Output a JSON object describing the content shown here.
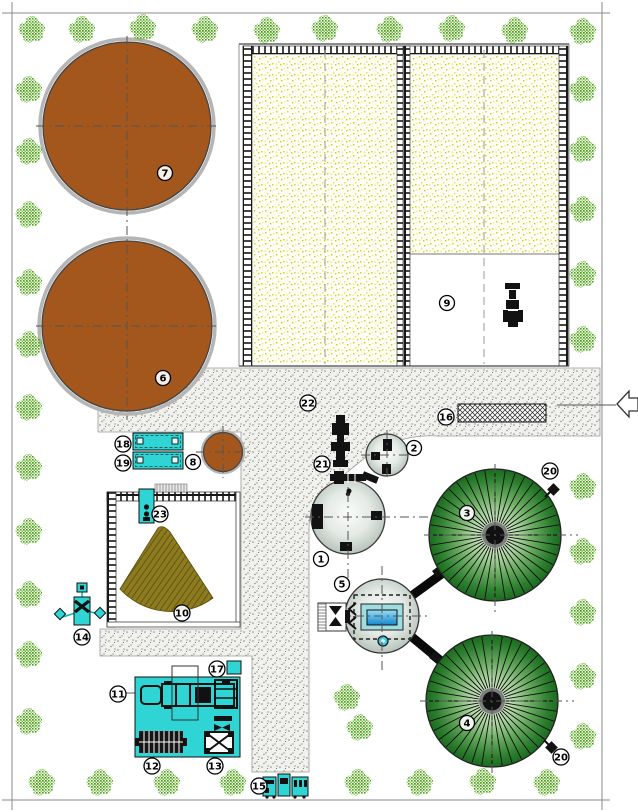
{
  "markers": {
    "1": "1",
    "2": "2",
    "3": "3",
    "4": "4",
    "5": "5",
    "6": "6",
    "7": "7",
    "8": "8",
    "9": "9",
    "10": "10",
    "11": "11",
    "12": "12",
    "13": "13",
    "14": "14",
    "15": "15",
    "16": "16",
    "17": "17",
    "18": "18",
    "19": "19",
    "20": "20",
    "20b": "20",
    "21": "21",
    "22": "22",
    "23": "23"
  },
  "colors": {
    "lagoon_brown": "#a3571c",
    "pile_olive": "#8d7b20",
    "equipment_cyan": "#2fd5d5",
    "dome_green_dark": "#1b6a1f",
    "dome_green_light": "#eef7ea",
    "barn_stipple_yellow": "#d2d428",
    "road_gray": "#f1f1ee",
    "tree_green": "#4aa315",
    "water_blue": "#1487cc"
  },
  "icons": {
    "tree": "tree-icon",
    "tractor_big": "tractor-icon",
    "tractor_small": "tractor-icon",
    "truck": "truck-trailer-icon",
    "flare_a": "flare-icon",
    "flare_b": "flare-icon",
    "entrance_arrow": "entrance-arrow-icon"
  }
}
